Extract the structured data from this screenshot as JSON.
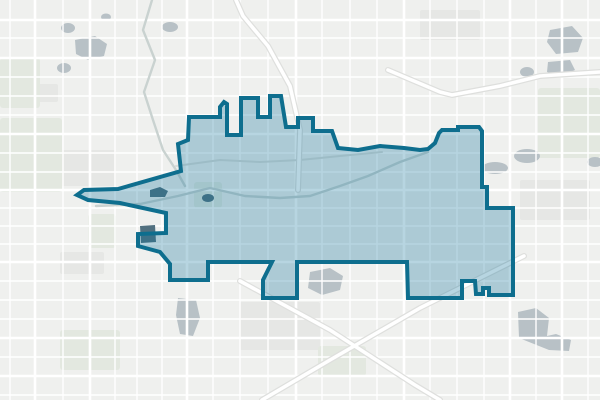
{
  "map": {
    "kind": "neighborhood-boundary-map",
    "background_color": "#eff0ee",
    "boundary": {
      "name": "highlighted-district-boundary",
      "stroke_color": "#0e6e8e",
      "stroke_width": 4,
      "fill_color": "rgba(15,117,155,0.30)",
      "points": [
        [
          189,
          117
        ],
        [
          220,
          117
        ],
        [
          220,
          107
        ],
        [
          224,
          102
        ],
        [
          227,
          104
        ],
        [
          227,
          135
        ],
        [
          241,
          135
        ],
        [
          241,
          98
        ],
        [
          258,
          98
        ],
        [
          258,
          117
        ],
        [
          270,
          117
        ],
        [
          270,
          96
        ],
        [
          281,
          96
        ],
        [
          286,
          127
        ],
        [
          298,
          127
        ],
        [
          298,
          118
        ],
        [
          313,
          118
        ],
        [
          313,
          131
        ],
        [
          332,
          131
        ],
        [
          338,
          148
        ],
        [
          358,
          150
        ],
        [
          380,
          146
        ],
        [
          404,
          148
        ],
        [
          420,
          150
        ],
        [
          428,
          149
        ],
        [
          435,
          143
        ],
        [
          439,
          133
        ],
        [
          442,
          130
        ],
        [
          458,
          130
        ],
        [
          458,
          127
        ],
        [
          479,
          127
        ],
        [
          482,
          131
        ],
        [
          482,
          187
        ],
        [
          487,
          187
        ],
        [
          487,
          208
        ],
        [
          513,
          208
        ],
        [
          513,
          295
        ],
        [
          489,
          295
        ],
        [
          489,
          288
        ],
        [
          483,
          288
        ],
        [
          483,
          294
        ],
        [
          476,
          294
        ],
        [
          475,
          281
        ],
        [
          462,
          281
        ],
        [
          462,
          298
        ],
        [
          408,
          298
        ],
        [
          407,
          262
        ],
        [
          297,
          262
        ],
        [
          297,
          298
        ],
        [
          263,
          298
        ],
        [
          263,
          280
        ],
        [
          272,
          262
        ],
        [
          208,
          262
        ],
        [
          208,
          280
        ],
        [
          170,
          280
        ],
        [
          170,
          264
        ],
        [
          160,
          252
        ],
        [
          138,
          246
        ],
        [
          138,
          234
        ],
        [
          166,
          233
        ],
        [
          166,
          213
        ],
        [
          120,
          203
        ],
        [
          88,
          200
        ],
        [
          77,
          195
        ],
        [
          84,
          190
        ],
        [
          118,
          189
        ],
        [
          181,
          171
        ],
        [
          178,
          144
        ],
        [
          188,
          140
        ]
      ]
    },
    "streets": {
      "minor_color": "#ffffff",
      "minor_width": 1.4,
      "arterial_color": "#ffffff",
      "arterial_width": 2.6,
      "minor_vertical_x": [
        10,
        63,
        115,
        137,
        162,
        213,
        240,
        268,
        322,
        350,
        377,
        430,
        457,
        484,
        536,
        588
      ],
      "minor_horizontal_y": [
        38,
        77,
        96,
        115,
        153,
        172,
        208,
        226,
        244,
        281,
        300,
        319,
        357,
        395
      ],
      "arterial_vertical_x": [
        35,
        90,
        187,
        296,
        404,
        510,
        562
      ],
      "arterial_horizontal_y": [
        20,
        58,
        134,
        190,
        262,
        338,
        376
      ]
    },
    "highways": {
      "casing_color": "#dedfdd",
      "casing_width": 6,
      "road_color": "#ffffff",
      "road_width": 3.6,
      "paths": [
        [
          [
            262,
            400
          ],
          [
            330,
            360
          ],
          [
            420,
            308
          ],
          [
            512,
            262
          ],
          [
            524,
            256
          ]
        ],
        [
          [
            240,
            281
          ],
          [
            330,
            330
          ],
          [
            415,
            385
          ],
          [
            440,
            400
          ]
        ],
        [
          [
            236,
            0
          ],
          [
            243,
            16
          ],
          [
            268,
            46
          ],
          [
            290,
            86
          ],
          [
            300,
            130
          ],
          [
            298,
            190
          ]
        ],
        [
          [
            388,
            70
          ],
          [
            440,
            92
          ],
          [
            452,
            95
          ],
          [
            500,
            86
          ],
          [
            540,
            76
          ],
          [
            600,
            72
          ]
        ]
      ]
    },
    "creeks": {
      "color": "#c9d2d0",
      "width": 2.4,
      "paths": [
        [
          [
            152,
            0
          ],
          [
            143,
            30
          ],
          [
            155,
            60
          ],
          [
            144,
            92
          ],
          [
            153,
            120
          ],
          [
            163,
            150
          ],
          [
            176,
            170
          ],
          [
            185,
            186
          ]
        ],
        [
          [
            96,
            206
          ],
          [
            140,
            204
          ],
          [
            178,
            196
          ],
          [
            210,
            188
          ],
          [
            245,
            196
          ],
          [
            280,
            198
          ],
          [
            310,
            196
          ],
          [
            340,
            186
          ],
          [
            368,
            176
          ],
          [
            400,
            162
          ],
          [
            428,
            152
          ]
        ]
      ]
    },
    "railline": {
      "color": "#dadcd9",
      "width": 2,
      "paths": [
        [
          [
            176,
            166
          ],
          [
            220,
            160
          ],
          [
            260,
            162
          ],
          [
            300,
            160
          ],
          [
            340,
            156
          ],
          [
            382,
            152
          ]
        ]
      ]
    },
    "water": {
      "color": "#b8c1c6",
      "dark_color": "#51707f",
      "polygons": [
        [
          [
            75,
            40
          ],
          [
            95,
            36
          ],
          [
            107,
            44
          ],
          [
            104,
            56
          ],
          [
            88,
            60
          ],
          [
            76,
            54
          ]
        ],
        [
          [
            550,
            30
          ],
          [
            572,
            26
          ],
          [
            583,
            38
          ],
          [
            578,
            52
          ],
          [
            556,
            54
          ],
          [
            547,
            42
          ]
        ],
        [
          [
            548,
            62
          ],
          [
            570,
            60
          ],
          [
            575,
            70
          ],
          [
            560,
            77
          ],
          [
            547,
            72
          ]
        ],
        [
          [
            518,
            312
          ],
          [
            536,
            308
          ],
          [
            549,
            318
          ],
          [
            547,
            336
          ],
          [
            556,
            334
          ],
          [
            571,
            340
          ],
          [
            569,
            351
          ],
          [
            549,
            350
          ],
          [
            534,
            344
          ],
          [
            519,
            338
          ]
        ],
        [
          [
            178,
            298
          ],
          [
            196,
            300
          ],
          [
            200,
            318
          ],
          [
            193,
            336
          ],
          [
            180,
            334
          ],
          [
            176,
            315
          ]
        ],
        [
          [
            310,
            272
          ],
          [
            330,
            268
          ],
          [
            343,
            276
          ],
          [
            340,
            290
          ],
          [
            322,
            295
          ],
          [
            308,
            288
          ]
        ]
      ],
      "ellipses": [
        {
          "cx": 68,
          "cy": 28,
          "rx": 7,
          "ry": 5
        },
        {
          "cx": 64,
          "cy": 68,
          "rx": 7,
          "ry": 5
        },
        {
          "cx": 170,
          "cy": 27,
          "rx": 8,
          "ry": 5
        },
        {
          "cx": 106,
          "cy": 17,
          "rx": 5,
          "ry": 3.5
        },
        {
          "cx": 527,
          "cy": 72,
          "rx": 7,
          "ry": 5
        },
        {
          "cx": 495,
          "cy": 168,
          "rx": 13,
          "ry": 6
        },
        {
          "cx": 527,
          "cy": 156,
          "rx": 13,
          "ry": 7
        },
        {
          "cx": 595,
          "cy": 162,
          "rx": 8,
          "ry": 5
        }
      ],
      "dark_polygons": [
        [
          [
            150,
            190
          ],
          [
            160,
            187
          ],
          [
            168,
            191
          ],
          [
            165,
            197
          ],
          [
            150,
            197
          ]
        ],
        [
          [
            140,
            226
          ],
          [
            155,
            225
          ],
          [
            156,
            242
          ],
          [
            141,
            243
          ]
        ]
      ],
      "dark_ellipses": [
        {
          "cx": 208,
          "cy": 198,
          "rx": 6,
          "ry": 4
        }
      ]
    },
    "parks": {
      "color": "#e3e8e0",
      "rects": [
        {
          "x": 0,
          "y": 118,
          "w": 62,
          "h": 74
        },
        {
          "x": 0,
          "y": 58,
          "w": 40,
          "h": 50
        },
        {
          "x": 88,
          "y": 214,
          "w": 28,
          "h": 34
        },
        {
          "x": 194,
          "y": 182,
          "w": 28,
          "h": 26
        },
        {
          "x": 318,
          "y": 346,
          "w": 48,
          "h": 30
        },
        {
          "x": 538,
          "y": 88,
          "w": 62,
          "h": 70
        },
        {
          "x": 60,
          "y": 330,
          "w": 60,
          "h": 40
        }
      ]
    },
    "blocks": {
      "color": "#e6e7e5",
      "rects": [
        {
          "x": 16,
          "y": 84,
          "w": 42,
          "h": 18
        },
        {
          "x": 520,
          "y": 180,
          "w": 70,
          "h": 40
        },
        {
          "x": 240,
          "y": 302,
          "w": 80,
          "h": 48
        },
        {
          "x": 60,
          "y": 150,
          "w": 56,
          "h": 36
        },
        {
          "x": 420,
          "y": 10,
          "w": 60,
          "h": 30
        },
        {
          "x": 60,
          "y": 252,
          "w": 44,
          "h": 22
        }
      ]
    }
  }
}
